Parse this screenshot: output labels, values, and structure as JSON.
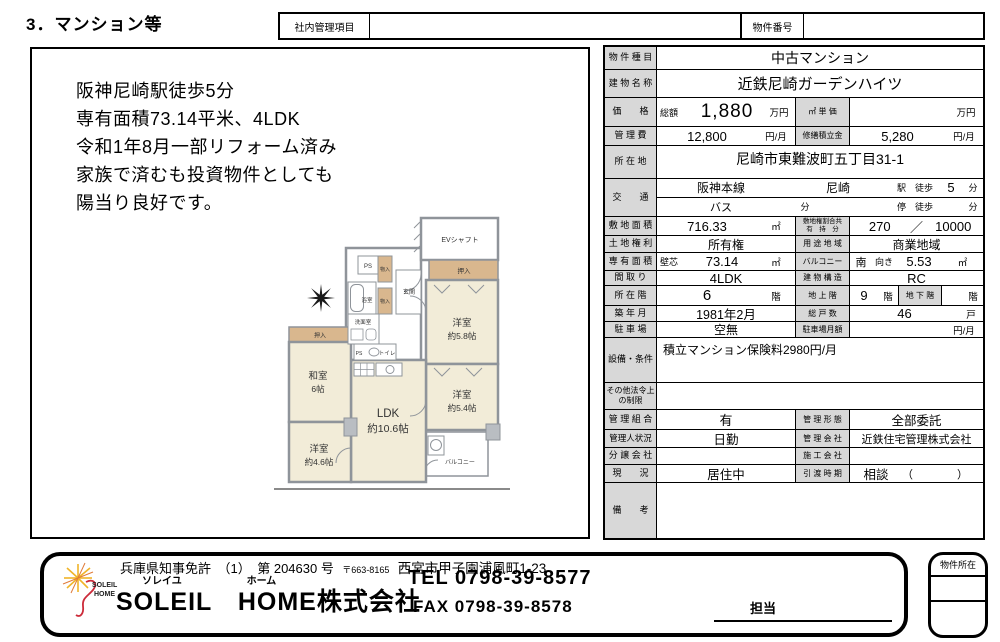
{
  "page_title": "3．マンション等",
  "header": {
    "internal_label": "社内管理項目",
    "internal_value": "",
    "property_no_label": "物件番号",
    "property_no_value": ""
  },
  "description": {
    "lines": [
      "阪神尼崎駅徒歩5分",
      "専有面積73.14平米、4LDK",
      "令和1年8月一部リフォーム済み",
      "家族で済むも投資物件としても",
      "陽当り良好です。"
    ]
  },
  "floorplan": {
    "ev_shaft": "EVシャフト",
    "closet": "押入",
    "storage": "物入",
    "ps": "PS",
    "bath": "浴室",
    "entrance": "玄関",
    "washroom": "洗面室",
    "toilet": "トイレ",
    "western_58_name": "洋室",
    "western_58_size": "約5.8帖",
    "western_54_name": "洋室",
    "western_54_size": "約5.4帖",
    "western_46_name": "洋室",
    "western_46_size": "約4.6帖",
    "japanese_name": "和室",
    "japanese_size": "6帖",
    "ldk_name": "LDK",
    "ldk_size": "約10.6帖",
    "balcony": "バルコニー",
    "colors": {
      "room": "#f2ecd8",
      "closet": "#d9b78e",
      "wall": "#8f949a"
    }
  },
  "table": {
    "property_type": {
      "label": "物 件 種 目",
      "value": "中古マンション"
    },
    "building_name": {
      "label": "建 物 名 称",
      "value": "近鉄尼崎ガーデンハイツ"
    },
    "price": {
      "label": "価　　格",
      "total_label": "総額",
      "total": "1,880",
      "unit": "万円",
      "sqm_label": "㎡ 単 価",
      "sqm_value": "",
      "sqm_unit": "万円"
    },
    "mgmt_fee": {
      "label": "管 理 費",
      "value": "12,800",
      "unit": "円/月",
      "repair_label": "修繕積立金",
      "repair_value": "5,280",
      "repair_unit": "円/月"
    },
    "location": {
      "label": "所 在 地",
      "value": "尼崎市東難波町五丁目31-1"
    },
    "transport": {
      "label": "交　　通",
      "line": "阪神本線",
      "station": "尼崎",
      "walk_label": "駅　徒歩",
      "walk_min": "5",
      "min_label": "分",
      "bus_label": "バス",
      "bus_min_label": "分",
      "stop_label": "停　徒歩",
      "stop_min_label": "分"
    },
    "land_area": {
      "label": "敷 地 面 積",
      "value": "716.33",
      "unit": "㎡",
      "share_label1": "敷地権割合共",
      "share_label2": "有　持　分",
      "share_num": "270",
      "share_slash": "／",
      "share_den": "10000"
    },
    "land_rights": {
      "label": "土 地 権 利",
      "value": "所有権",
      "zone_label": "用 途 地 域",
      "zone_value": "商業地域"
    },
    "exclusive_area": {
      "label": "専 有 面 積",
      "method": "壁芯",
      "value": "73.14",
      "unit": "㎡",
      "balcony_label": "バルコニー",
      "direction": "南",
      "direction_suffix": "向き",
      "balcony_value": "5.53",
      "balcony_unit": "㎡"
    },
    "layout": {
      "label": "間 取 り",
      "value": "4LDK",
      "structure_label": "建 物 構 造",
      "structure_value": "RC"
    },
    "floor": {
      "label": "所 在 階",
      "value": "6",
      "unit": "階",
      "above_label": "地 上 階",
      "above_value": "9",
      "above_unit": "階",
      "below_label": "地 下 階",
      "below_value": "",
      "below_unit": "階"
    },
    "built": {
      "label": "築 年 月",
      "value": "1981年2月",
      "total_units_label": "総 戸 数",
      "total_units": "46",
      "total_units_unit": "戸"
    },
    "parking": {
      "label": "駐 車 場",
      "value": "空無",
      "monthly_label": "駐車場月額",
      "monthly_value": "",
      "monthly_unit": "円/月"
    },
    "equipment": {
      "label": "設備・条件",
      "value": "積立マンション保険料2980円/月"
    },
    "other_restrictions": {
      "label": "その他法令上の制限",
      "value": ""
    },
    "mgmt_assoc": {
      "label": "管 理 組 合",
      "value": "有",
      "form_label": "管 理 形 態",
      "form_value": "全部委託"
    },
    "manager": {
      "label": "管理人状況",
      "value": "日勤",
      "company_label": "管 理 会 社",
      "company_value": "近鉄住宅管理株式会社"
    },
    "sales_company": {
      "label": "分 譲 会 社",
      "value": "",
      "construction_label": "施 工 会 社",
      "construction_value": ""
    },
    "current_status": {
      "label": "現　　況",
      "value": "居住中",
      "handover_label": "引 渡 時 期",
      "handover_value": "相談",
      "handover_paren": "（　　　　）"
    },
    "remarks": {
      "label": "備　　考",
      "value": ""
    }
  },
  "footer": {
    "license": "兵庫県知事免許　（1）　第 204630 号",
    "postal_code": "〒663-8165",
    "address": "西宮市甲子園浦風町1-23",
    "furigana_soleil": "ソレイユ",
    "furigana_home": "ホーム",
    "company_name": "SOLEIL　HOME株式会社",
    "tel": "TEL 0798-39-8577",
    "fax": "FAX 0798-39-8578",
    "staff_label": "担当",
    "stamp_label": "物件所在",
    "logo_text1": "SOLEIL",
    "logo_text2": "HOME"
  }
}
